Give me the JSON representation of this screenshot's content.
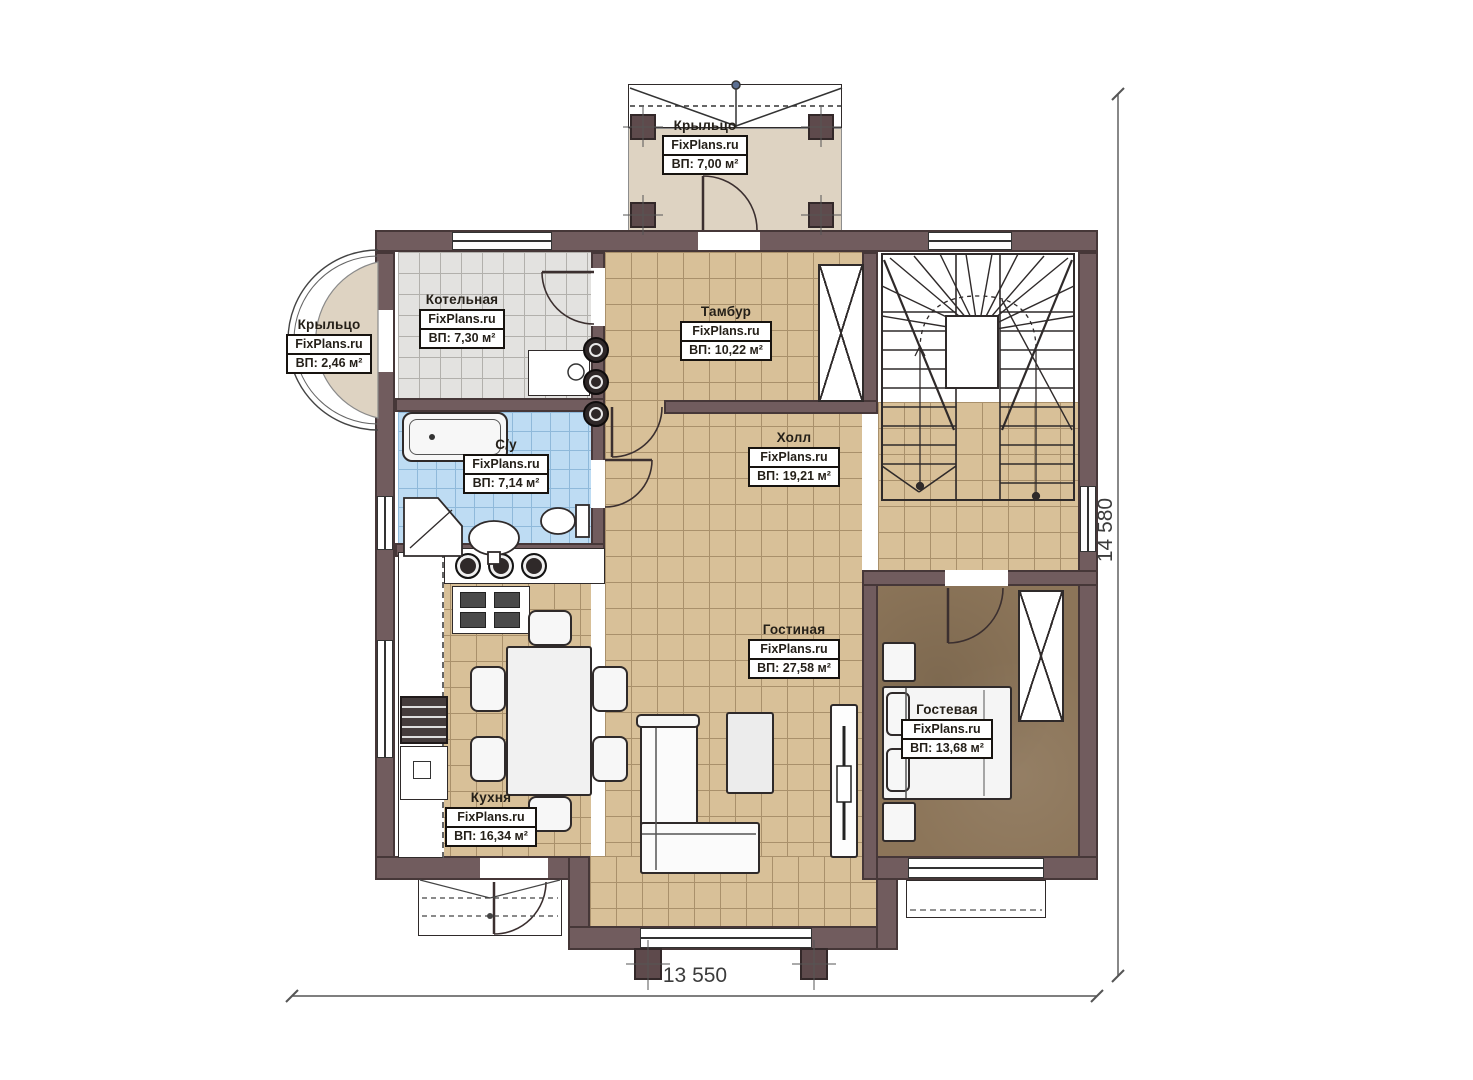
{
  "watermark": "FixPlans.ru",
  "rooms": [
    {
      "id": "porch-top",
      "name": "Крыльцо",
      "area": "ВП: 7,00 м²"
    },
    {
      "id": "porch-left",
      "name": "Крыльцо",
      "area": "ВП: 2,46 м²"
    },
    {
      "id": "boiler",
      "name": "Котельная",
      "area": "ВП: 7,30 м²"
    },
    {
      "id": "vestibule",
      "name": "Тамбур",
      "area": "ВП: 10,22 м²"
    },
    {
      "id": "bathroom",
      "name": "С/у",
      "area": "ВП: 7,14 м²"
    },
    {
      "id": "hall",
      "name": "Холл",
      "area": "ВП: 19,21 м²"
    },
    {
      "id": "living",
      "name": "Гостиная",
      "area": "ВП: 27,58 м²"
    },
    {
      "id": "kitchen",
      "name": "Кухня",
      "area": "ВП: 16,34 м²"
    },
    {
      "id": "guest",
      "name": "Гостевая",
      "area": "ВП: 13,68 м²"
    }
  ],
  "dimensions": {
    "width": "13 550",
    "height": "14 580"
  },
  "colors": {
    "wall": "#715c5e",
    "floor_tile_tan": "#d8c098",
    "floor_tile_gray": "#e3e2e0",
    "floor_tile_blue": "#bedcf3",
    "floor_guest": "#8c7559",
    "floor_porch": "#ded3c2"
  }
}
